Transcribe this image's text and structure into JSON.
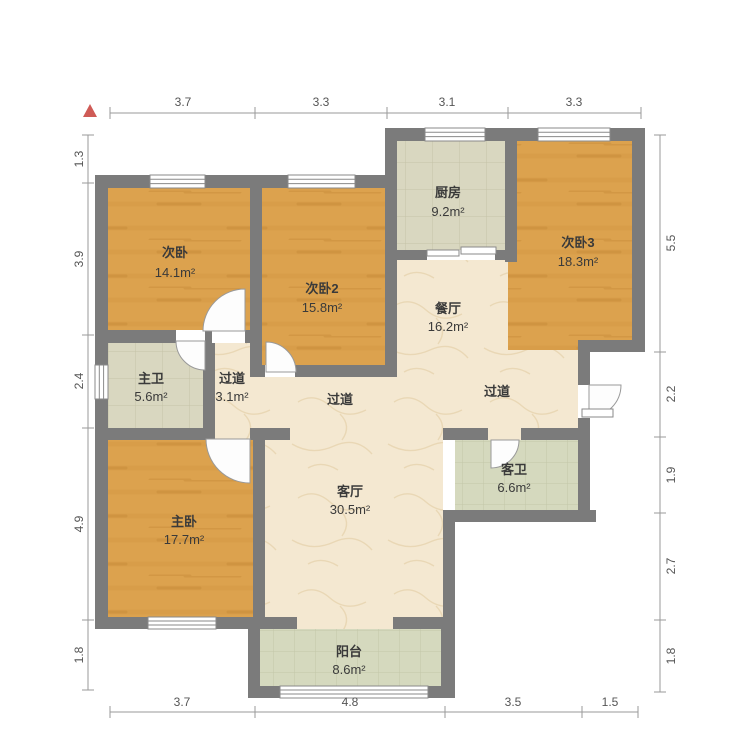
{
  "plan_title": "apartment-floor-plan",
  "north_indicator": "north",
  "rooms": {
    "bedroom_a": {
      "name": "次卧",
      "area": "14.1m²"
    },
    "bedroom_b": {
      "name": "次卧2",
      "area": "15.8m²"
    },
    "bedroom_c": {
      "name": "次卧3",
      "area": "18.3m²"
    },
    "master_bedroom": {
      "name": "主卧",
      "area": "17.7m²"
    },
    "kitchen": {
      "name": "厨房",
      "area": "9.2m²"
    },
    "dining": {
      "name": "餐厅",
      "area": "16.2m²"
    },
    "living": {
      "name": "客厅",
      "area": "30.5m²"
    },
    "master_bath": {
      "name": "主卫",
      "area": "5.6m²"
    },
    "guest_bath": {
      "name": "客卫",
      "area": "6.6m²"
    },
    "hallway_small": {
      "name": "过道",
      "area": "3.1m²"
    },
    "hallway_mid": {
      "name": "过道"
    },
    "hallway_east": {
      "name": "过道"
    },
    "balcony": {
      "name": "阳台",
      "area": "8.6m²"
    }
  },
  "dimensions": {
    "top": [
      "3.7",
      "3.3",
      "3.1",
      "3.3"
    ],
    "left": [
      "1.3",
      "3.9",
      "2.4",
      "4.9",
      "1.8"
    ],
    "right": [
      "5.5",
      "2.2",
      "1.9",
      "2.7",
      "1.8"
    ],
    "bottom": [
      "3.7",
      "4.8",
      "3.5",
      "1.5"
    ]
  },
  "colors": {
    "wall": "#7b7b7b",
    "wood_floor": "#dca24e",
    "tile_warm": "#d9d7c0",
    "tile_green": "#d5d9be",
    "stone_floor": "#f4e8d1",
    "north_arrow": "#cf5b56",
    "dimension_text": "#555555"
  }
}
